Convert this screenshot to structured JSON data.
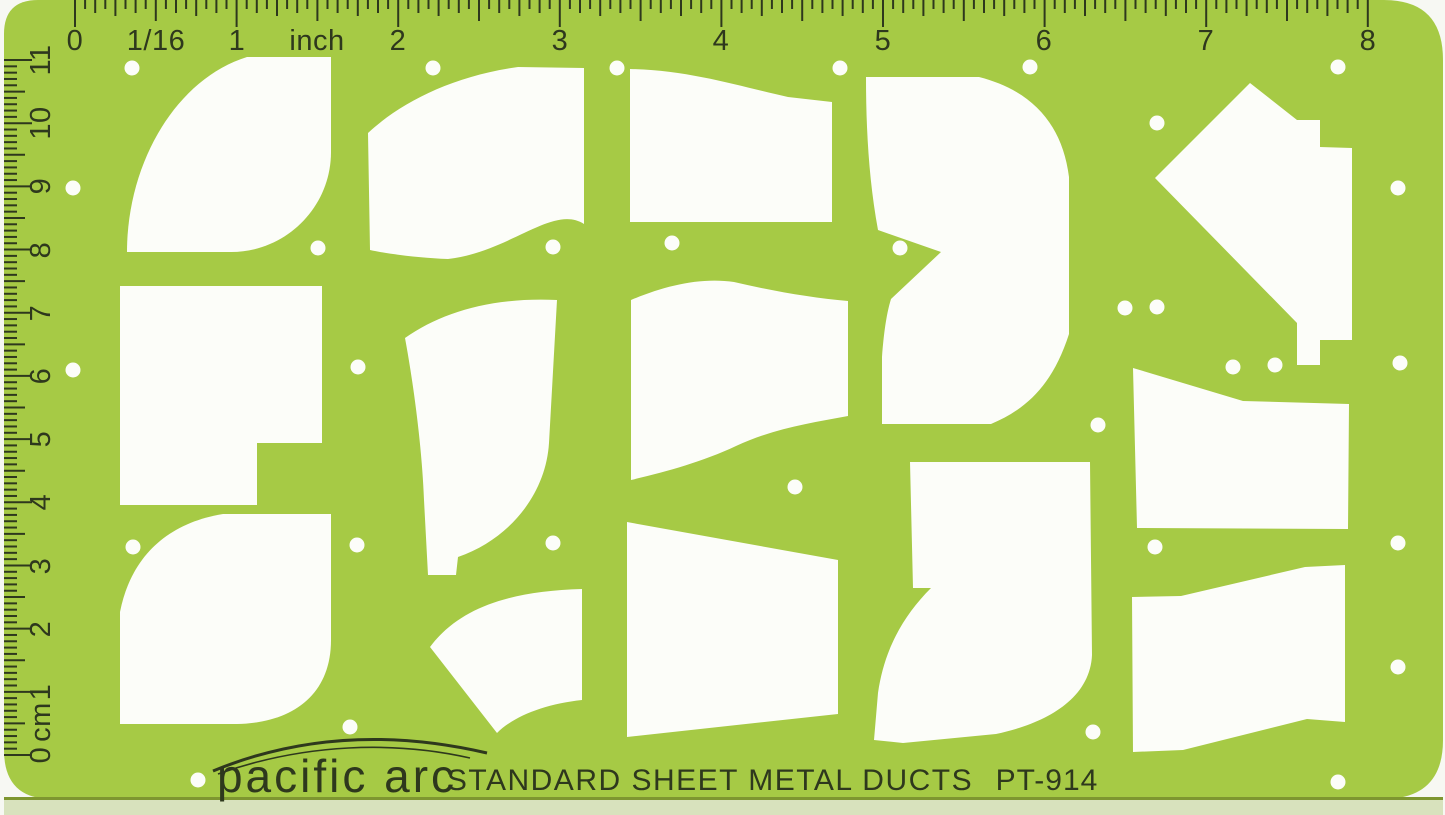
{
  "template": {
    "brand": "pacific arc",
    "title": "STANDARD SHEET METAL DUCTS",
    "model": "PT-914"
  },
  "rulers": {
    "top_inches": {
      "labels": [
        "0",
        "1/16",
        "1",
        "inch",
        "2",
        "3",
        "4",
        "5",
        "6",
        "7",
        "8"
      ]
    },
    "left_cm": {
      "labels": [
        "11",
        "10",
        "9",
        "8",
        "7",
        "6",
        "5",
        "4",
        "3",
        "2",
        "1",
        "cm",
        "0"
      ]
    }
  },
  "colors": {
    "body_green": "#a6ca45",
    "ink": "#2e381d",
    "cutout_white": "#fcfdf9",
    "page_background": "#f7f8f3",
    "bottom_edge_strip": "#d8e2bd",
    "bottom_edge_line": "#7e9630"
  }
}
